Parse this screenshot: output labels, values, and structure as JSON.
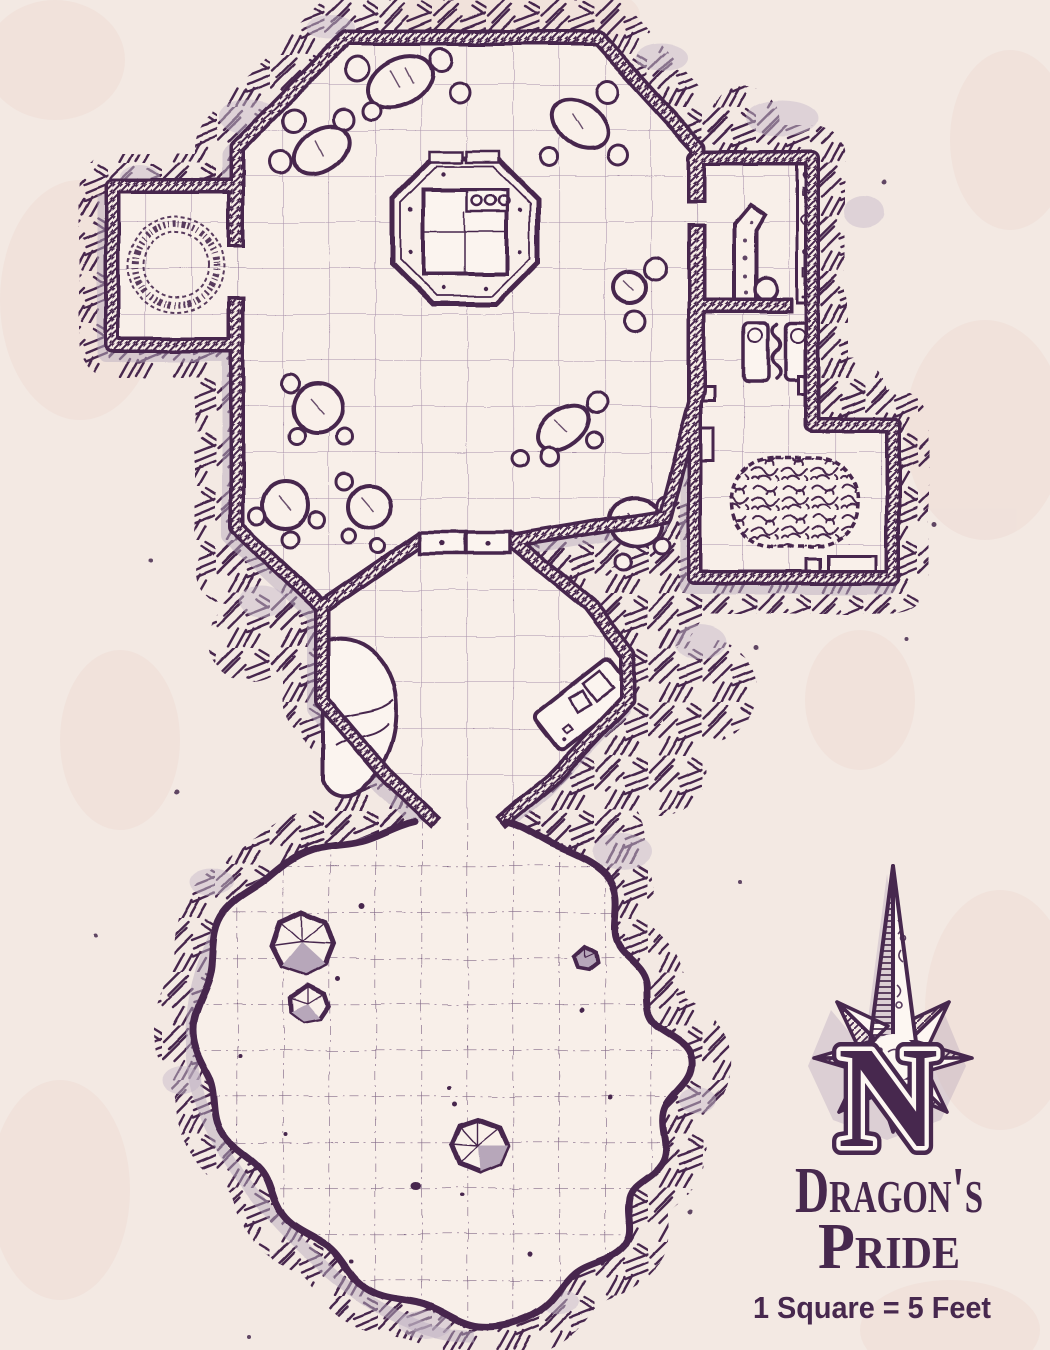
{
  "meta": {
    "type": "fantasy-dungeon-battle-map",
    "style": "hand-drawn ink on parchment"
  },
  "palette": {
    "ink": "#47284e",
    "parchment": "#f3e9e3",
    "floor": "#f8efe9",
    "paper_blotch": "#eedcd6",
    "shadow": "#bcaec0",
    "rock_shade": "#b7a7ba",
    "highlight": "#fdf7f2",
    "grid_line": "#8f7296"
  },
  "title": {
    "line1": "Dragon's",
    "line2": "Pride"
  },
  "scale_note": {
    "text": "1 Square = 5 Feet",
    "square_feet": 5
  },
  "compass": {
    "letter": "N",
    "style": "eight-point star, long north spike",
    "points_to": "top"
  },
  "grid": {
    "square_px": 46,
    "room_grid": "solid lines",
    "cavern_grid": "dash-dot lines"
  },
  "rooms": [
    {
      "id": "grand-hall",
      "shape": "large octagon",
      "features": [
        "central octagonal dais",
        "altar slab with three round sockets",
        "boulder clusters",
        "double door south",
        "door to rune chamber",
        "door to store room"
      ]
    },
    {
      "id": "rune-chamber",
      "shape": "small square room, west",
      "features": [
        "dotted circle of runes"
      ]
    },
    {
      "id": "store-room",
      "shape": "rectangle, north-east",
      "features": [
        "L-shaped counter",
        "round stool",
        "small crate",
        "shelf strip of sundries"
      ]
    },
    {
      "id": "bunk-room",
      "shape": "rectangle, east",
      "features": [
        "two beds with pillows",
        "wavy snake mark",
        "wall cabinet"
      ]
    },
    {
      "id": "rug-hall",
      "shape": "rectangle, south-east",
      "features": [
        "oval labyrinth rug",
        "bench",
        "two wall fixtures"
      ]
    },
    {
      "id": "antechamber",
      "shape": "small octagon, centre",
      "features": [
        "large rock mound",
        "tilted desk with papers"
      ]
    },
    {
      "id": "cavern",
      "shape": "large irregular cave, south",
      "features": [
        "stalagmites",
        "scattered stones",
        "dash-dot grid"
      ]
    }
  ]
}
